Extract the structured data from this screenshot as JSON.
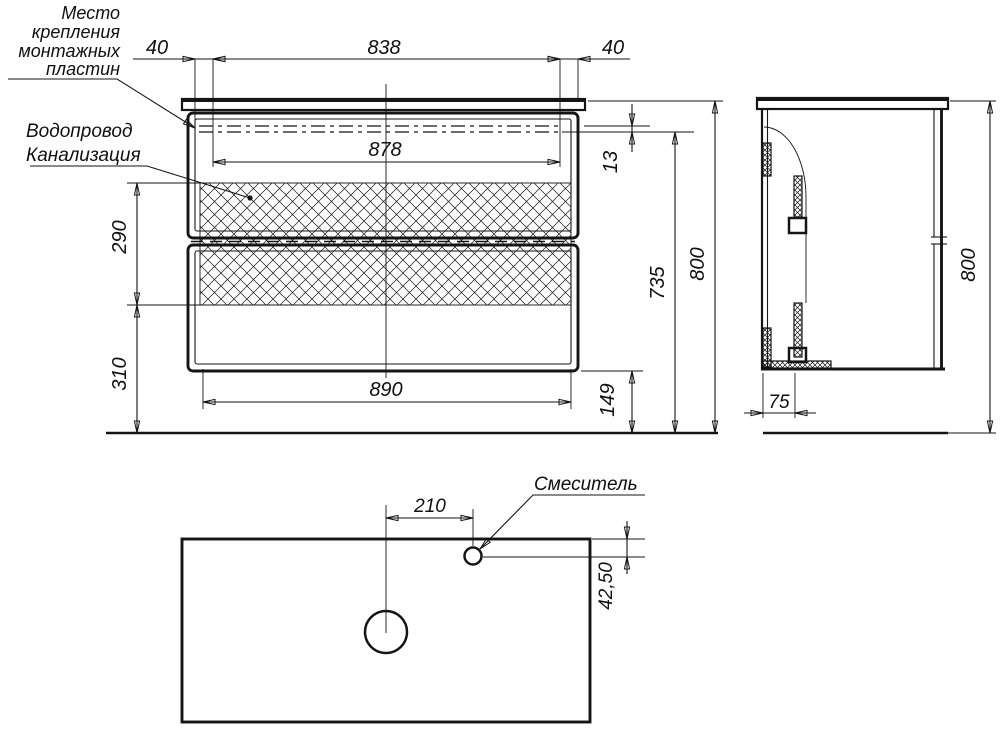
{
  "drawing": {
    "type": "furniture-installation-drawing",
    "colors": {
      "line": "#151515",
      "background": "#ffffff"
    },
    "labels": {
      "mounting_plates_note_lines": [
        "Место",
        "крепления",
        "монтажных",
        "пластин"
      ],
      "plumbing_note_lines": [
        "Водопровод",
        "Канализация"
      ],
      "mixer_label": "Смеситель"
    },
    "dimensions": {
      "front": {
        "plate_offset_left": "40",
        "plate_span": "838",
        "plate_offset_right": "40",
        "inner_width": "878",
        "plate_line_gap": "13",
        "service_zone_height": "290",
        "lower_zone_height": "310",
        "bottom_width": "890",
        "floor_clearance": "149",
        "mounting_height": "735",
        "total_height": "800"
      },
      "side": {
        "bracket_depth": "75",
        "total_height": "800"
      },
      "plan": {
        "mixer_offset_from_center": "210",
        "mixer_offset_from_edge": "42,50"
      }
    }
  }
}
